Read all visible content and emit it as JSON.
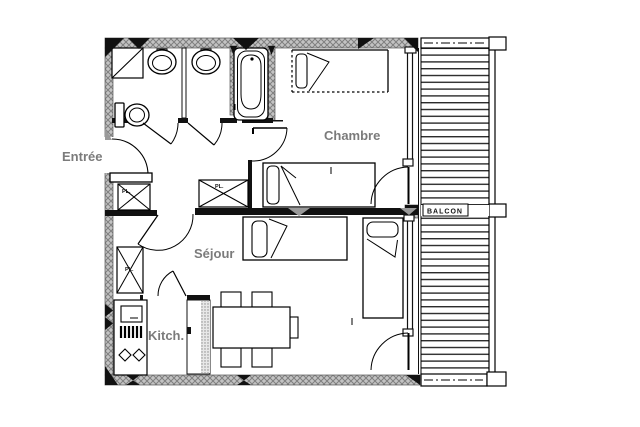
{
  "floorplan": {
    "rooms": [
      {
        "id": "entree",
        "label": "Entrée"
      },
      {
        "id": "chambre",
        "label": "Chambre"
      },
      {
        "id": "sejour",
        "label": "Séjour"
      },
      {
        "id": "kitchen",
        "label": "Kitch."
      },
      {
        "id": "balcony",
        "label": "BALCON"
      }
    ],
    "closets": [
      {
        "label": "PL."
      },
      {
        "label": "PL."
      },
      {
        "label": "PL."
      }
    ],
    "fixtures": [
      "shower",
      "washbasin",
      "washbasin",
      "toilet",
      "bathtub",
      "single-bed",
      "single-bed",
      "single-bed",
      "single-bed",
      "closet",
      "closet",
      "closet",
      "kitchen-unit",
      "cooktop",
      "burner-grill",
      "sink-basins",
      "dining-table",
      "chair",
      "chair",
      "chair",
      "chair",
      "chair",
      "balcony-decking",
      "balcony-railing"
    ],
    "colors": {
      "background": "#ffffff",
      "wall_fill": "#c3c3c3",
      "wall_hatch": "#7f7f7f",
      "line": "#000000",
      "label": "#7b7b7b"
    }
  }
}
